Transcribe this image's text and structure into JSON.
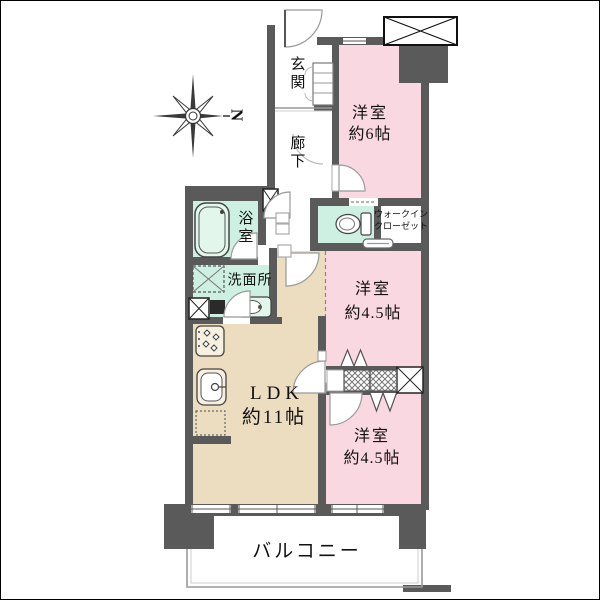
{
  "compass": {
    "label": "N"
  },
  "rooms": {
    "genkan": {
      "label": "玄関"
    },
    "rouka": {
      "label": "廊下"
    },
    "bedroom6": {
      "label": "洋室",
      "size": "約6帖"
    },
    "wic": {
      "line1": "ウォークイン",
      "line2": "クローゼット"
    },
    "bathroom": {
      "label": "浴室"
    },
    "washroom": {
      "label": "洗面所"
    },
    "ldk": {
      "label": "LDK",
      "size": "約11帖"
    },
    "bedroom45_mid": {
      "label": "洋室",
      "size": "約4.5帖"
    },
    "bedroom45_low": {
      "label": "洋室",
      "size": "約4.5帖"
    },
    "balcony": {
      "label": "バルコニー"
    }
  },
  "colors": {
    "wall": "#5a5a5a",
    "bedroom_pink": "#f9d8e2",
    "wet_area_mint": "#cdf0e3",
    "ldk_tan": "#ecddc1",
    "fence_gray": "#999999",
    "text": "#111111"
  },
  "icons": {
    "compass-rose": "eight-point star, north pointing right",
    "elevator-shaft": "crossed white box",
    "pipe-space": "small crossed box",
    "bathtub": "rounded tub outline",
    "washing-machine-pan": "dashed square with X",
    "washbasin": "counter with oval bowl",
    "toilet": "bowl with tank",
    "stove": "cooktop with burners",
    "kitchen-sink": "basin with faucet",
    "refrigerator": "dashed rectangle",
    "shoe-cabinet": "shelved box",
    "closet": "hatched boxes with bifold doors",
    "door": "quarter-circle swing arc",
    "window": "white gap with center line"
  }
}
